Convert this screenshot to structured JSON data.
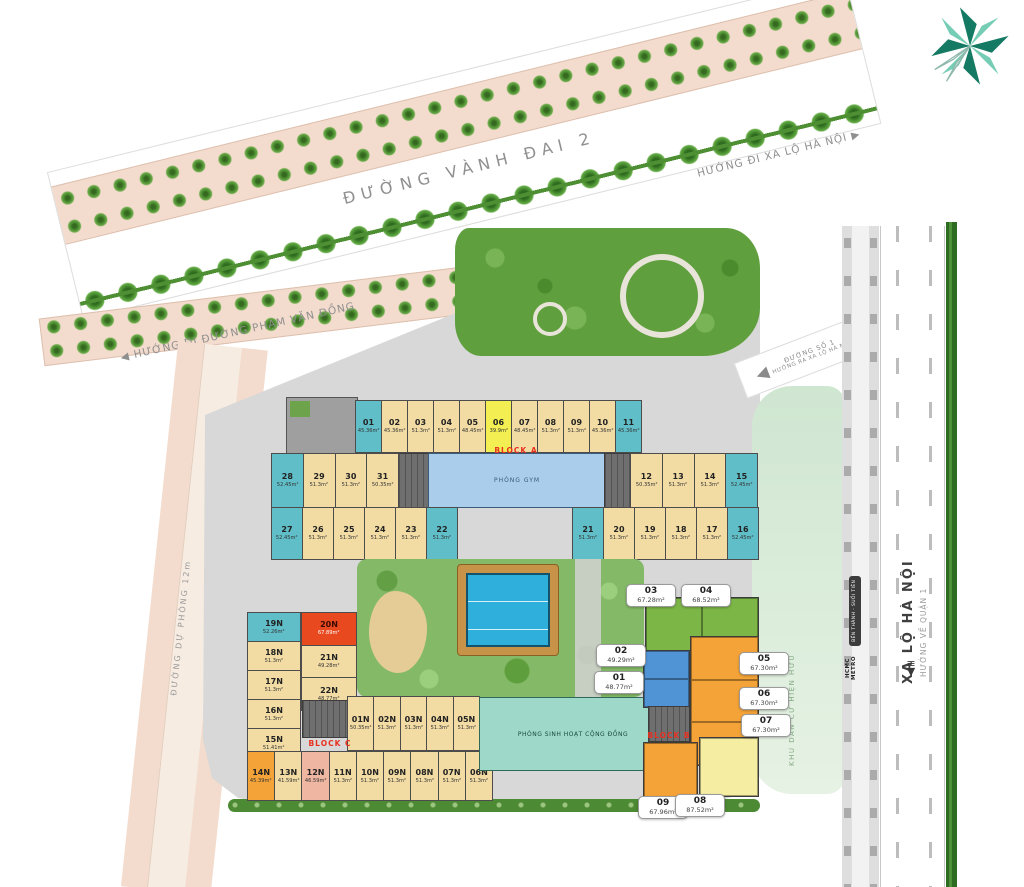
{
  "icons": {
    "arrow_right": "▶",
    "arrow_left": "◀",
    "arrow_down": "▼"
  },
  "roads": {
    "vanh_dai_2": "ĐƯỜNG VÀNH ĐAI 2",
    "dir_xa_lo_ha_noi": "HƯỚNG ĐI XA LỘ HÀ NỘI",
    "dir_pham_van_dong": "HƯỚNG ĐI ĐƯỜNG PHẠM VĂN ĐỒNG",
    "du_phong": "ĐƯỜNG DỰ PHÒNG 12m",
    "so_1_line1": "ĐƯỜNG SỐ 1",
    "so_1_line2": "HƯỚNG RA XA LỘ HÀ NỘI",
    "xa_lo_ha_noi": "XA LỘ HÀ NỘI",
    "huong_ve_quan_1": "HƯỚNG VỀ QUẬN 1"
  },
  "areas": {
    "khu_dan_cu": "KHU DÂN CƯ HIỆN HỮU",
    "metro": "HCMC METRO",
    "metro_line": "BẾN THÀNH - SUỐI TIÊN",
    "gym": "PHÒNG GYM",
    "community": "PHÒNG SINH HOẠT CỘNG ĐỒNG",
    "block_a": "BLOCK A",
    "block_b": "BLOCK B",
    "block_c": "BLOCK C"
  },
  "colors": {
    "unit_tan": "#f2dca4",
    "unit_teal": "#5fbec7",
    "unit_yellow": "#f3ee52",
    "unit_red": "#e8491f",
    "unit_orange": "#f4a338",
    "unit_pink": "#efb6a2",
    "unit_green": "#7cb647",
    "unit_blue": "#5194d6",
    "block_label_red": "#e8301f"
  },
  "units": {
    "rowA": [
      {
        "no": "01",
        "area": "45.36m²",
        "c": "teal"
      },
      {
        "no": "02",
        "area": "45.36m²"
      },
      {
        "no": "03",
        "area": "51.3m²"
      },
      {
        "no": "04",
        "area": "51.3m²"
      },
      {
        "no": "05",
        "area": "48.45m²"
      },
      {
        "no": "06",
        "area": "39.9m²",
        "c": "yellow"
      },
      {
        "no": "07",
        "area": "48.45m²"
      },
      {
        "no": "08",
        "area": "51.3m²"
      },
      {
        "no": "09",
        "area": "51.3m²"
      },
      {
        "no": "10",
        "area": "45.36m²"
      },
      {
        "no": "11",
        "area": "45.36m²",
        "c": "teal"
      }
    ],
    "row2L": [
      {
        "no": "28",
        "area": "52.45m²",
        "c": "teal"
      },
      {
        "no": "29",
        "area": "51.3m²"
      },
      {
        "no": "30",
        "area": "51.3m²"
      },
      {
        "no": "31",
        "area": "50.35m²"
      }
    ],
    "row2R": [
      {
        "no": "12",
        "area": "50.35m²"
      },
      {
        "no": "13",
        "area": "51.3m²"
      },
      {
        "no": "14",
        "area": "51.3m²"
      },
      {
        "no": "15",
        "area": "52.45m²",
        "c": "teal"
      }
    ],
    "row3L": [
      {
        "no": "27",
        "area": "52.45m²",
        "c": "teal"
      },
      {
        "no": "26",
        "area": "51.3m²"
      },
      {
        "no": "25",
        "area": "51.3m²"
      },
      {
        "no": "24",
        "area": "51.3m²"
      },
      {
        "no": "23",
        "area": "51.3m²"
      },
      {
        "no": "22",
        "area": "51.3m²",
        "c": "teal"
      }
    ],
    "row3R": [
      {
        "no": "21",
        "area": "51.3m²",
        "c": "teal"
      },
      {
        "no": "20",
        "area": "51.3m²"
      },
      {
        "no": "19",
        "area": "51.3m²"
      },
      {
        "no": "18",
        "area": "51.3m²"
      },
      {
        "no": "17",
        "area": "51.3m²"
      },
      {
        "no": "16",
        "area": "52.45m²",
        "c": "teal"
      }
    ],
    "colL": [
      {
        "no": "19N",
        "area": "52.26m²",
        "c": "teal"
      },
      {
        "no": "18N",
        "area": "51.3m²"
      },
      {
        "no": "17N",
        "area": "51.3m²"
      },
      {
        "no": "16N",
        "area": "51.3m²"
      },
      {
        "no": "15N",
        "area": "51.41m²"
      }
    ],
    "colL2": [
      {
        "no": "20N",
        "area": "67.89m²",
        "c": "red"
      },
      {
        "no": "21N",
        "area": "49.28m²"
      },
      {
        "no": "22N",
        "area": "48.77m²"
      }
    ],
    "rowN1": [
      {
        "no": "01N",
        "area": "50.35m²"
      },
      {
        "no": "02N",
        "area": "51.3m²"
      },
      {
        "no": "03N",
        "area": "51.3m²"
      },
      {
        "no": "04N",
        "area": "51.3m²"
      },
      {
        "no": "05N",
        "area": "51.3m²"
      }
    ],
    "rowN2": [
      {
        "no": "14N",
        "area": "45.39m²",
        "c": "orange"
      },
      {
        "no": "13N",
        "area": "41.59m²"
      },
      {
        "no": "12N",
        "area": "46.59m²",
        "c": "pink"
      },
      {
        "no": "11N",
        "area": "51.3m²"
      },
      {
        "no": "10N",
        "area": "51.3m²"
      },
      {
        "no": "09N",
        "area": "51.3m²"
      },
      {
        "no": "08N",
        "area": "51.3m²"
      },
      {
        "no": "07N",
        "area": "51.3m²"
      },
      {
        "no": "06N",
        "area": "51.3m²"
      }
    ]
  },
  "callouts": {
    "c01": {
      "no": "01",
      "area": "48.77m²"
    },
    "c02": {
      "no": "02",
      "area": "49.29m²"
    },
    "c03": {
      "no": "03",
      "area": "67.28m²"
    },
    "c04": {
      "no": "04",
      "area": "68.52m²"
    },
    "c05": {
      "no": "05",
      "area": "67.30m²"
    },
    "c06": {
      "no": "06",
      "area": "67.30m²"
    },
    "c07": {
      "no": "07",
      "area": "67.30m²"
    },
    "c08": {
      "no": "08",
      "area": "87.52m²"
    },
    "c09": {
      "no": "09",
      "area": "67.96m²"
    }
  }
}
